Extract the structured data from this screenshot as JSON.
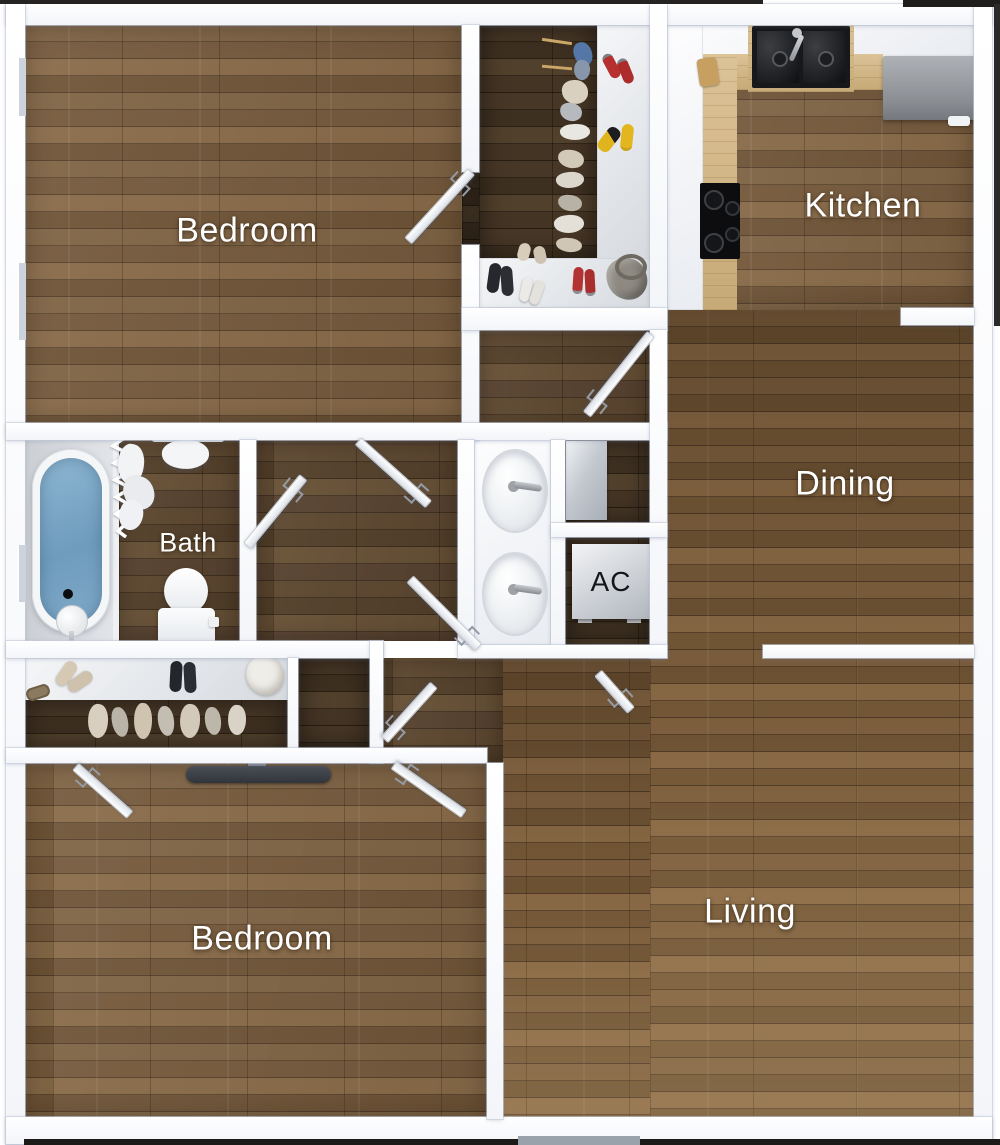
{
  "rooms": {
    "bedroom1": {
      "label": "Bedroom"
    },
    "kitchen": {
      "label": "Kitchen"
    },
    "dining": {
      "label": "Dining"
    },
    "bath": {
      "label": "Bath"
    },
    "ac": {
      "label": "AC"
    },
    "bedroom2": {
      "label": "Bedroom"
    },
    "living": {
      "label": "Living"
    }
  },
  "colors": {
    "wall": "#fcfdfe",
    "floor_medium": "#72573a",
    "floor_dark": "#3a2d1f",
    "bath_floor": "#d6d9dd",
    "tub_water": "#7ba7c7",
    "counter_wood": "#d3b990",
    "appliance_grey": "#979ba1",
    "label_text": "#ffffff",
    "ac_label_text": "#15161a"
  }
}
